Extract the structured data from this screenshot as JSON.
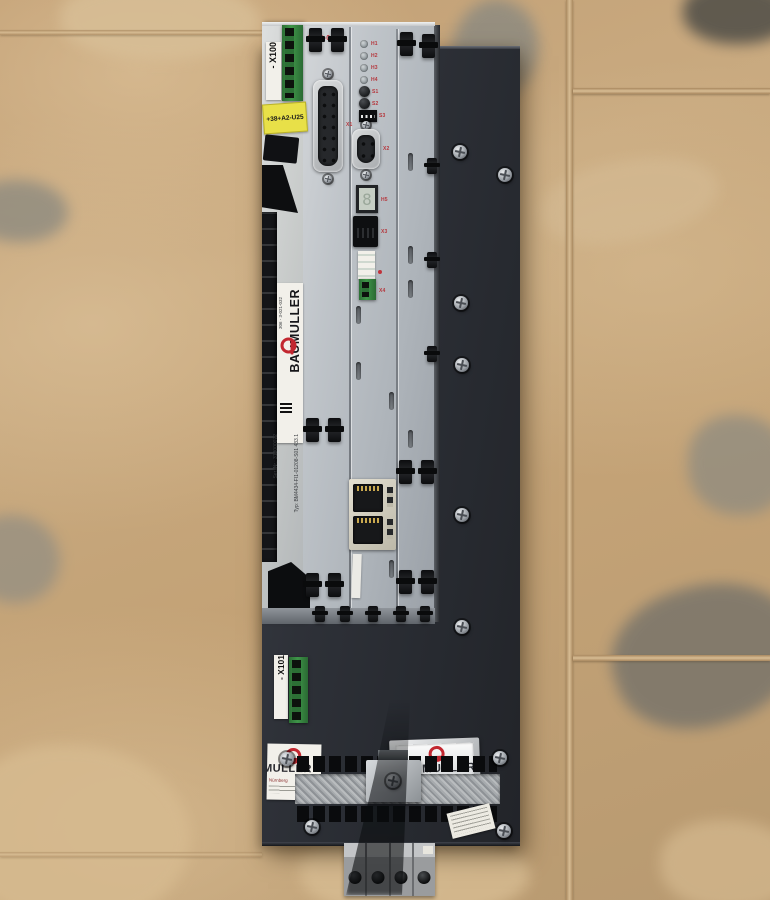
{
  "device": {
    "psu_module": {
      "x100_label": "- X100",
      "location_tag": "+38+A2-U25",
      "brand_vertical": "BAUMULLER",
      "brand_part_no": "306 - 3-021-032",
      "type_line": "Typ: BM4434-FI1-01208-S01 433.1",
      "serial_line": "Ser. Nr.: 313000072"
    },
    "enc_module": {
      "name": "ENC-01",
      "led_labels": [
        "H1",
        "H2",
        "H3",
        "H4"
      ],
      "button_labels": [
        "S1",
        "S2"
      ],
      "dip_label": "S3",
      "dsub15_label": "X1",
      "dsub9_label": "X2",
      "display_label": "H5",
      "display_glyph": "8",
      "rj_label": "X3",
      "terminal_label": "X4"
    },
    "chassis": {
      "x101_label": "- X101",
      "muller_label_partial": "MULLER",
      "muller_label_sub": "Nürnberg",
      "brand_plate": "BAUMULLER"
    }
  },
  "colors": {
    "brand_red": "#c22730",
    "chassis_dark": "#2b2e34",
    "module_grey": "#c2c6cb",
    "tag_yellow": "#e8e048",
    "connector_green": "#2f7a38",
    "floor_tan": "#c9aa80"
  }
}
